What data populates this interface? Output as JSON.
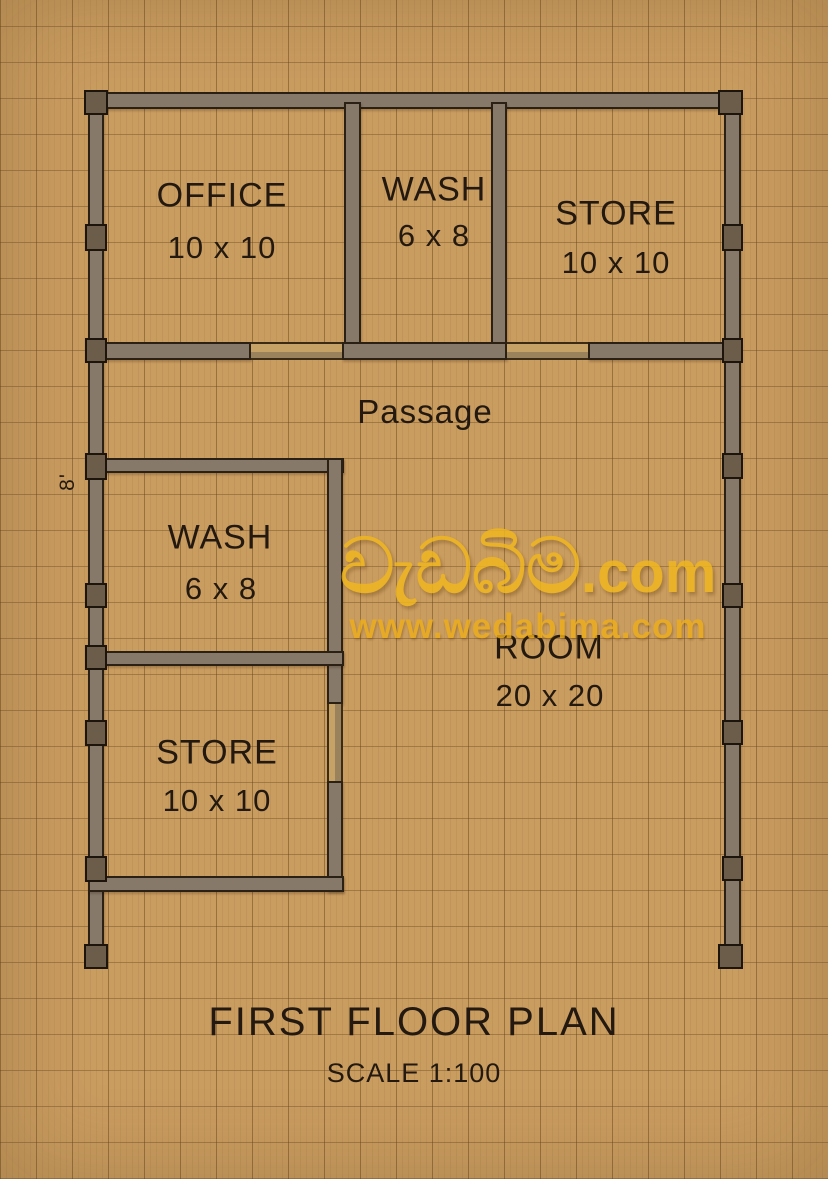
{
  "plan": {
    "title": "FIRST FLOOR PLAN",
    "scale_label": "SCALE 1:100",
    "side_dimension": "8'",
    "rooms": [
      {
        "id": "office",
        "name": "OFFICE",
        "dims": "10 x 10"
      },
      {
        "id": "wash-top",
        "name": "WASH",
        "dims": "6 x 8"
      },
      {
        "id": "store-top",
        "name": "STORE",
        "dims": "10 x 10"
      },
      {
        "id": "passage",
        "name": "Passage",
        "dims": ""
      },
      {
        "id": "wash-middle",
        "name": "WASH",
        "dims": "6 x 8"
      },
      {
        "id": "room",
        "name": "ROOM",
        "dims": "20 x 20"
      },
      {
        "id": "store-bottom",
        "name": "STORE",
        "dims": "10 x 10"
      }
    ]
  },
  "watermark": {
    "brand": "වැඩබිම",
    "suffix": ".com",
    "url": "www.wedabima.com"
  },
  "colors": {
    "background": "#c99c60",
    "grid_line": "#8d6c3b",
    "wall_fill": "#87796a",
    "column_fill": "#6b5d4a",
    "wall_outline": "#2a2013",
    "text": "#231910",
    "watermark_yellow": "#f0b71f",
    "watermark_url": "#ecae1c"
  }
}
